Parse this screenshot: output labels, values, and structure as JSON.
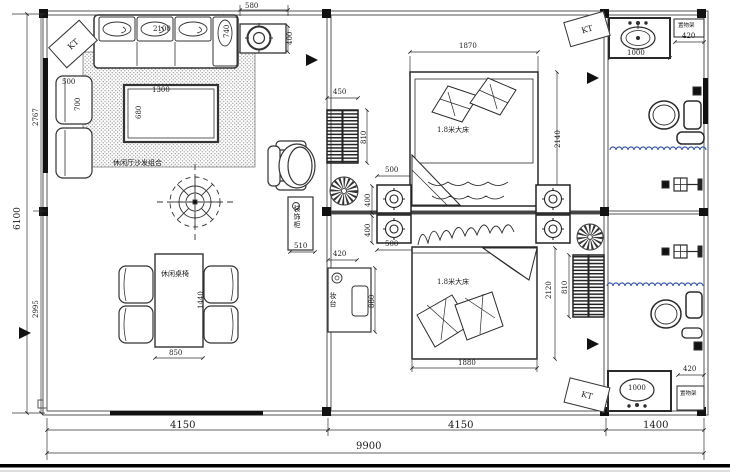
{
  "colors": {
    "line": "#2a2a2a",
    "wall": "#555555",
    "water": "#3a57a8",
    "hatch": "#111111"
  },
  "labels": {
    "kt": "KT",
    "sofa_group": "休闲厅沙发组合",
    "table_chairs": "休闲桌椅",
    "deco_cabinet": "装饰柜",
    "dresser": "妆台",
    "bed1": "1.8米大床",
    "bed2": "1.8米大床",
    "shelf1": "置物架",
    "shelf2": "置物架"
  },
  "dims": {
    "top_580": "580",
    "top_400": "400",
    "sofa_740": "740",
    "sofa_2100": "2100",
    "side_500": "500",
    "side_700": "700",
    "coffee_1300": "1300",
    "coffee_680": "680",
    "table_850": "850",
    "table_1440": "1440",
    "cab1_450": "450",
    "cab1_810": "810",
    "deco_510": "510",
    "ns_top_500": "500",
    "ns_top_400": "400",
    "ns_bot_500": "500",
    "ns_bot_400": "400",
    "dresser_420": "420",
    "dresser_880": "880",
    "bed1_1870": "1870",
    "bed1_2140": "2140",
    "bed2_1880": "1880",
    "bed2_2120": "2120",
    "cab2_810": "810",
    "bath1_1000": "1000",
    "bath1_420": "420",
    "bath2_1000": "1000",
    "bath2_420": "420",
    "bottom_4150_left": "4150",
    "bottom_4150_mid": "4150",
    "bottom_1400": "1400",
    "bottom_9900": "9900",
    "left_6100": "6100",
    "left_2767": "2767",
    "left_2995": "2995"
  }
}
